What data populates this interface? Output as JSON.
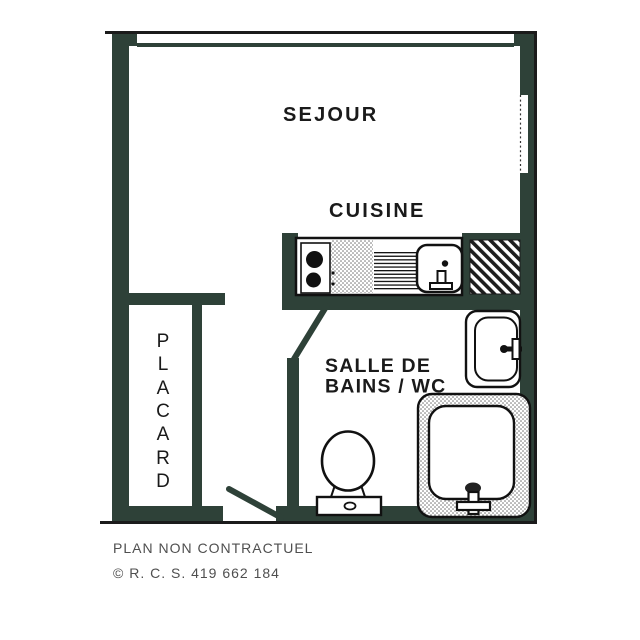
{
  "plan": {
    "rooms": {
      "sejour": {
        "label": "SEJOUR"
      },
      "cuisine": {
        "label": "CUISINE"
      },
      "salle_de_bains_wc": {
        "label_line1": "SALLE DE",
        "label_line2": "BAINS / WC"
      },
      "placard": {
        "label": "PLACARD",
        "letters": [
          "P",
          "L",
          "A",
          "C",
          "A",
          "R",
          "D"
        ]
      }
    },
    "fixtures": {
      "kitchen": [
        "cooktop",
        "worktop",
        "sink-drainer",
        "sink-basin"
      ],
      "bathroom": [
        "washbasin",
        "shower-tray",
        "toilet"
      ],
      "duct": "hatched-technical-shaft"
    },
    "doors": [
      "entrance-door-swing",
      "bathroom-door-swing"
    ],
    "windows": [
      "top-wall-window",
      "right-wall-window"
    ]
  },
  "footer": {
    "disclaimer": "PLAN NON CONTRACTUEL",
    "registration": "© R. C. S. 419 662 184"
  },
  "colors": {
    "wall": "#2e4138",
    "outline": "#1b1b1b",
    "label_text": "#1a1a1a",
    "footer_text": "#4f4f4f"
  }
}
